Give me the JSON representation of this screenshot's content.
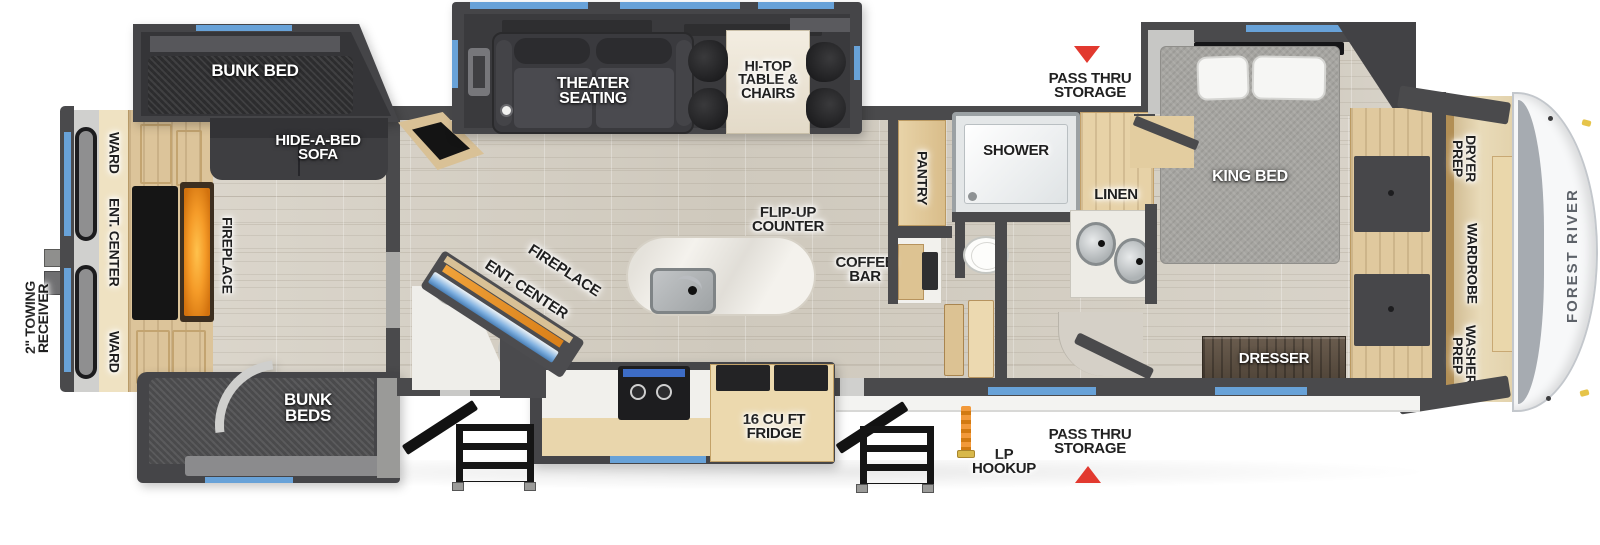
{
  "labels": {
    "towing": "2\" TOWING\nRECEIVER",
    "ward_top": "WARD",
    "ent_center_rear": "ENT. CENTER",
    "ward_bottom": "WARD",
    "fireplace_rear": "FIREPLACE",
    "bunk_bed": "BUNK BED",
    "hide_a_bed": "HIDE-A-BED\nSOFA",
    "bunk_beds": "BUNK\nBEDS",
    "theater": "THEATER\nSEATING",
    "hitop": "HI-TOP\nTABLE &\nCHAIRS",
    "flip_up": "FLIP-UP\nCOUNTER",
    "ent_center_main": "ENT. CENTER",
    "fireplace_main": "FIREPLACE",
    "coffee_bar": "COFFEE\nBAR",
    "fridge": "16 CU FT\nFRIDGE",
    "lp_hookup": "LP\nHOOKUP",
    "pass_thru_top": "PASS THRU\nSTORAGE",
    "pass_thru_bottom": "PASS THRU\nSTORAGE",
    "pantry": "PANTRY",
    "shower": "SHOWER",
    "linen": "LINEN",
    "king_bed": "KING BED",
    "dresser": "DRESSER",
    "dryer_prep": "DRYER\nPREP",
    "wardrobe": "WARDROBE",
    "washer_prep": "WASHER\nPREP",
    "brand": "FOREST RIVER"
  },
  "colors": {
    "wall": "#4a4a4c",
    "blue": "#68a2d8",
    "red": "#e2392f",
    "orange": "#f59b28",
    "wood": "#e0c99e",
    "floor": "#d6d1c7"
  }
}
